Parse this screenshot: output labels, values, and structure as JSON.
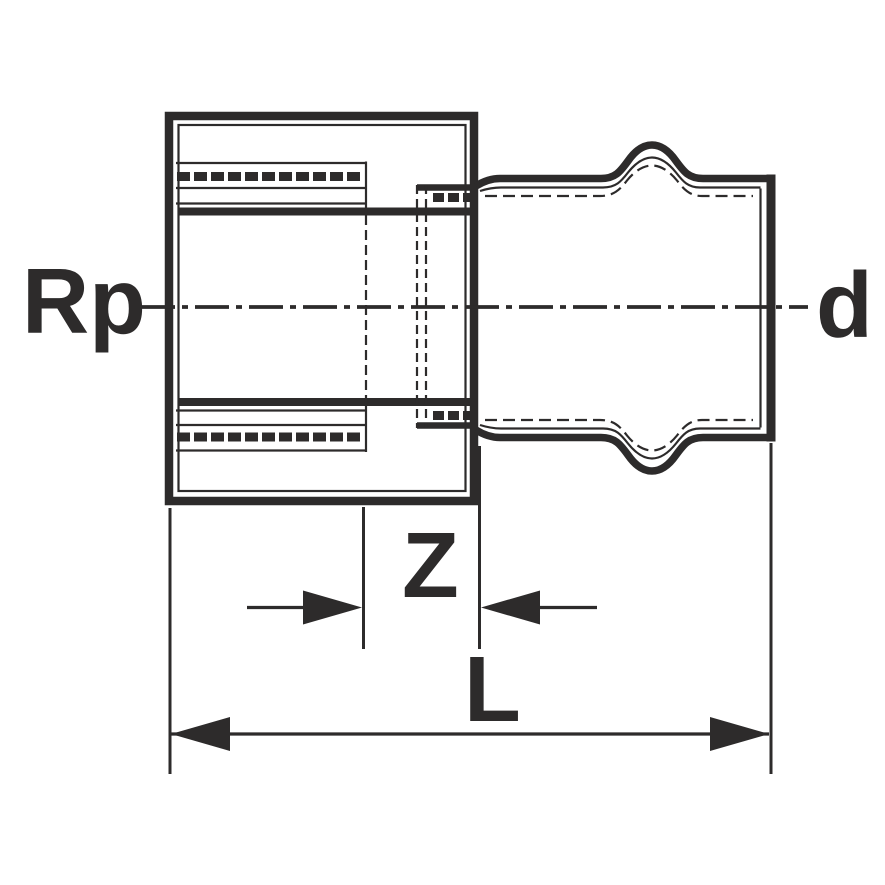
{
  "drawing": {
    "type": "pipe-fitting-section-dimension-drawing",
    "labels": {
      "thread_side": "Rp",
      "press_side": "d",
      "offset_dim": "Z",
      "length_dim": "L"
    },
    "colors": {
      "line": "#2d2b2b",
      "background": "#ffffff"
    }
  }
}
